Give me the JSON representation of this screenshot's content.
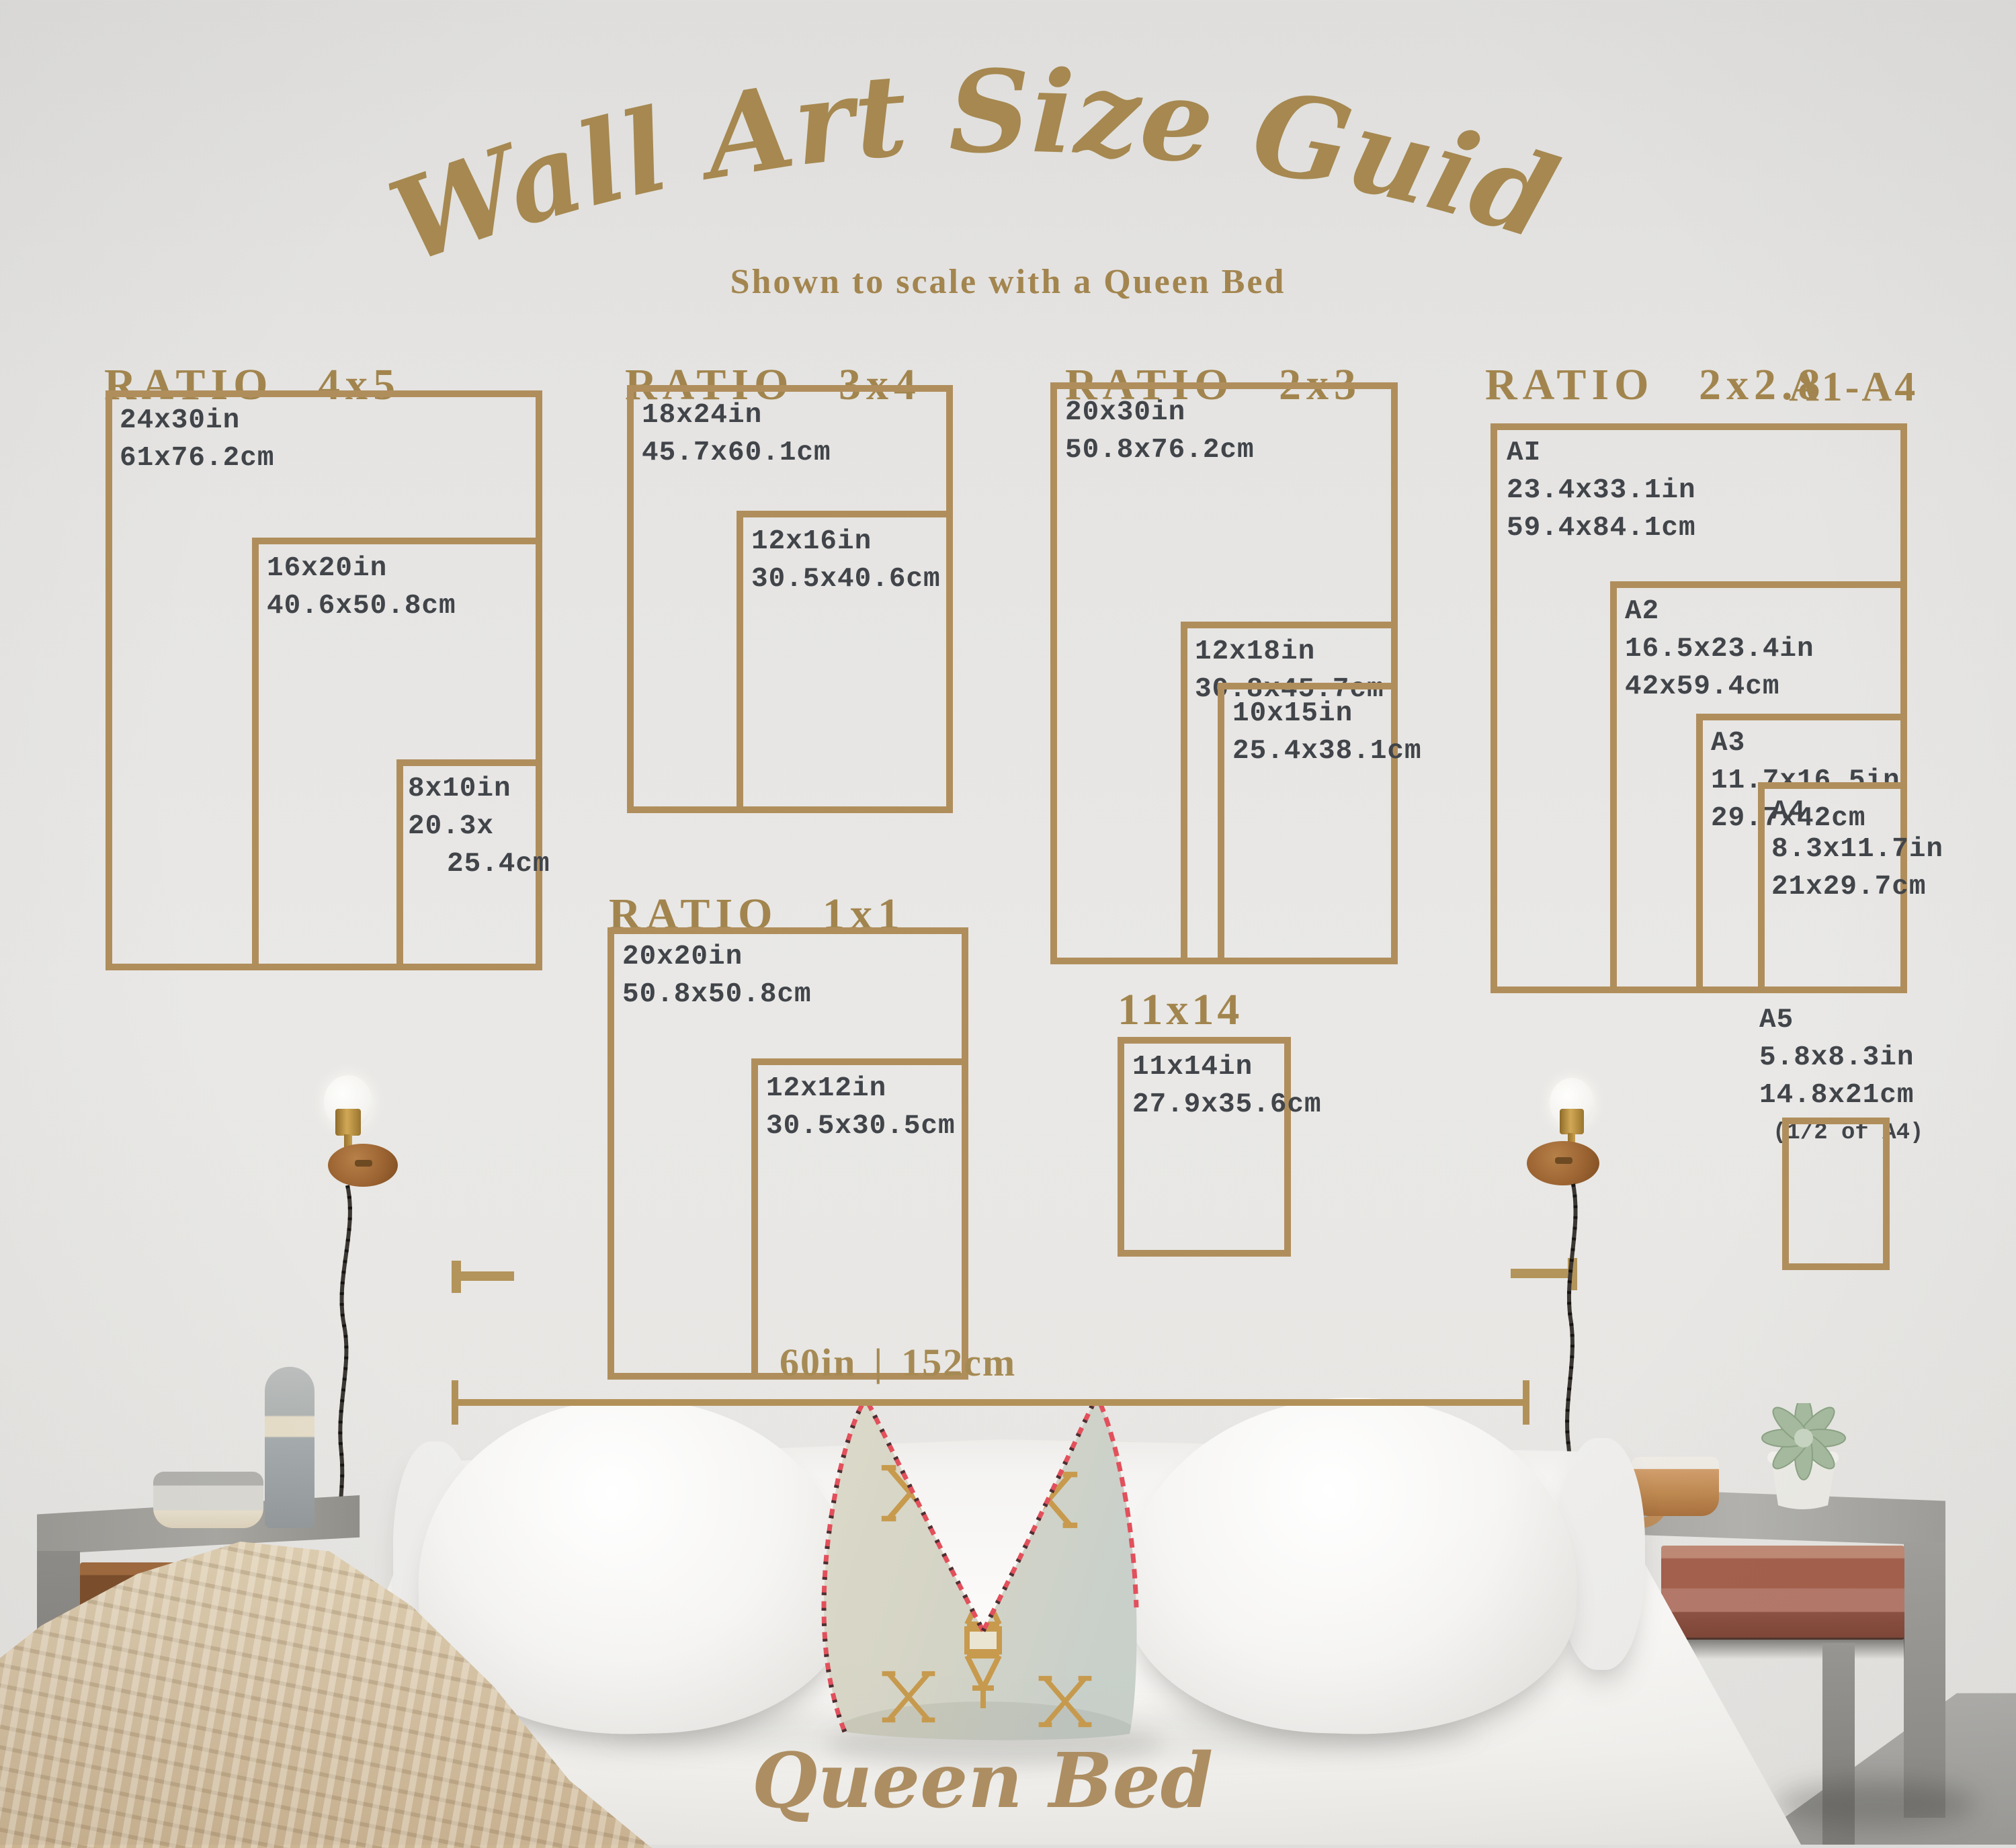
{
  "title": "Wall Art Size Guide",
  "subtitle": "Shown to scale with a Queen Bed",
  "bed_label": "Queen Bed",
  "measurement": {
    "inches": "60in",
    "divider": "|",
    "cm": "152cm"
  },
  "colors": {
    "gold_line": "#b08e5c",
    "gold_heading": "#a2854e",
    "gold_script": "#a68850",
    "label_text": "#41454a",
    "wall": "#e5e4e2"
  },
  "sections": [
    {
      "heading": "RATIO  4x5",
      "rects": [
        {
          "name": "24x30in",
          "lines": [
            "24x30in",
            "61x76.2cm"
          ]
        },
        {
          "name": "16x20in",
          "lines": [
            "16x20in",
            "40.6x50.8cm"
          ]
        },
        {
          "name": "8x10in",
          "lines": [
            "8x10in",
            "20.3x",
            "25.4cm"
          ]
        }
      ]
    },
    {
      "heading": "RATIO  3x4",
      "rects": [
        {
          "name": "18x24in",
          "lines": [
            "18x24in",
            "45.7x60.1cm"
          ]
        },
        {
          "name": "12x16in",
          "lines": [
            "12x16in",
            "30.5x40.6cm"
          ]
        }
      ]
    },
    {
      "heading": "RATIO  2x3",
      "rects": [
        {
          "name": "20x30in",
          "lines": [
            "20x30in",
            "50.8x76.2cm"
          ]
        },
        {
          "name": "12x18in",
          "lines": [
            "12x18in",
            "30.8x45.7cm"
          ]
        },
        {
          "name": "10x15in",
          "lines": [
            "10x15in",
            "25.4x38.1cm"
          ]
        }
      ]
    },
    {
      "heading": "RATIO  2x2.8",
      "heading2": "A1-A4",
      "rects": [
        {
          "name": "A1",
          "lines": [
            "AI",
            "23.4x33.1in",
            "59.4x84.1cm"
          ]
        },
        {
          "name": "A2",
          "lines": [
            "A2",
            "16.5x23.4in",
            "42x59.4cm"
          ]
        },
        {
          "name": "A3",
          "lines": [
            "A3",
            "11.7x16.5in",
            "29.7x42cm"
          ]
        },
        {
          "name": "A4",
          "lines": [
            "A4",
            "8.3x11.7in",
            "21x29.7cm"
          ]
        }
      ],
      "a5": {
        "lines": [
          "A5",
          "5.8x8.3in",
          "14.8x21cm"
        ],
        "note": "(1/2 of A4)"
      }
    },
    {
      "heading": "RATIO  1x1",
      "rects": [
        {
          "name": "20x20in",
          "lines": [
            "20x20in",
            "50.8x50.8cm"
          ]
        },
        {
          "name": "12x12in",
          "lines": [
            "12x12in",
            "30.5x30.5cm"
          ]
        }
      ]
    },
    {
      "heading": "11x14",
      "rects": [
        {
          "name": "11x14in",
          "lines": [
            "11x14in",
            "27.9x35.6cm"
          ]
        }
      ]
    }
  ]
}
